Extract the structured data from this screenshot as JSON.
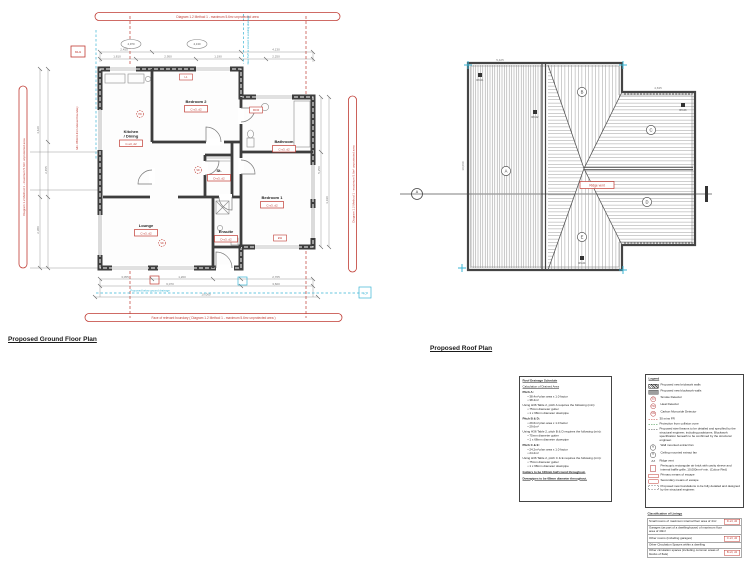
{
  "titles": {
    "ground": "Proposed Ground Floor Plan",
    "roof": "Proposed Roof Plan"
  },
  "colors": {
    "red": "#c03b33",
    "cyan": "#3ab5d5",
    "wall": "#3d3d3d",
    "dim": "#777777"
  },
  "floor_plan": {
    "rooms": [
      {
        "name": "Kitchen / Dining",
        "code": "C-s3, d2",
        "x": 131,
        "y": 133
      },
      {
        "name": "Bedroom 2",
        "code": "C-s3, d2",
        "x": 196,
        "y": 103
      },
      {
        "name": "Bathroom",
        "code": "C-s3, d2",
        "x": 284,
        "y": 143
      },
      {
        "name": "St.",
        "code": "D-s3, d2",
        "x": 219,
        "y": 172
      },
      {
        "name": "Lounge",
        "code": "C-s3, d2",
        "x": 146,
        "y": 227
      },
      {
        "name": "Ensuite",
        "code": "D-s3, d2",
        "x": 226,
        "y": 233
      },
      {
        "name": "Bedroom 1",
        "code": "C-s3, d2",
        "x": 272,
        "y": 199
      }
    ],
    "banners": {
      "top": "Diagram 1.2 Method 1 - maximum 5.6m² unprotected area",
      "bottom": "Face of relevant boundary ( Diagram 1.2 Method 1 - maximum 5.6m² unprotected area )",
      "left": "Diagram 1.2 Method 1 - maximum 5.6m² unprotected area",
      "right": "Diagram 1.2 Method 1 - maximum 5.6m² unprotected area"
    },
    "notes": {
      "boundary": "Min. 850mm from relevant boundary",
      "svp": "New SVP to connect to existing drainage",
      "drain": "Proposed below ground drainage",
      "mh": "MH1",
      "ic": "IC"
    },
    "grid_bubbles": [
      "4,970",
      "4,130"
    ],
    "detectors": [
      {
        "g": "HD",
        "x": 140,
        "y": 114
      },
      {
        "g": "SD",
        "x": 198,
        "y": 170
      },
      {
        "g": "SD",
        "x": 162,
        "y": 243
      }
    ],
    "wall_tags": [
      {
        "t": "L1",
        "x": 186,
        "y": 77
      },
      {
        "t": "FD30",
        "x": 256,
        "y": 110
      },
      {
        "t": "EW",
        "x": 280,
        "y": 238
      }
    ],
    "dims": [
      {
        "t": "2,455",
        "x": 124,
        "y": 50.5
      },
      {
        "t": "4,130",
        "x": 276,
        "y": 50.5
      },
      {
        "t": "1,810",
        "x": 117,
        "y": 57.5
      },
      {
        "t": "2,950",
        "x": 168,
        "y": 57.5
      },
      {
        "t": "1,190",
        "x": 218,
        "y": 57.5
      },
      {
        "t": "2,250",
        "x": 276,
        "y": 57.5
      },
      {
        "t": "3,055",
        "x": 125,
        "y": 277.8
      },
      {
        "t": "1,200",
        "x": 182,
        "y": 277.8
      },
      {
        "t": "2,765",
        "x": 276,
        "y": 277.8
      },
      {
        "t": "6,070",
        "x": 170,
        "y": 284.8
      },
      {
        "t": "3,600",
        "x": 276,
        "y": 284.8
      },
      {
        "t": "10,060",
        "x": 206,
        "y": 295.5
      },
      {
        "t": "4,420",
        "x": 39,
        "y": 130,
        "r": -90
      },
      {
        "t": "2,380",
        "x": 39,
        "y": 230,
        "r": -90
      },
      {
        "t": "2,455",
        "x": 47,
        "y": 170,
        "r": -90
      },
      {
        "t": "5,250",
        "x": 320,
        "y": 170,
        "r": -90
      },
      {
        "t": "3,190",
        "x": 328,
        "y": 200,
        "r": -90
      }
    ]
  },
  "roof_plan": {
    "ridge_label": "Ridge vent",
    "section_letter": "A",
    "letters": [
      {
        "t": "A",
        "x": 106,
        "y": 141
      },
      {
        "t": "B",
        "x": 182,
        "y": 62
      },
      {
        "t": "C",
        "x": 251,
        "y": 100
      },
      {
        "t": "D",
        "x": 247,
        "y": 172
      },
      {
        "t": "E",
        "x": 182,
        "y": 207
      }
    ],
    "vents": [
      {
        "t": "RV-01",
        "x": 80,
        "y": 45
      },
      {
        "t": "RV-02",
        "x": 135,
        "y": 82
      },
      {
        "t": "RV-03",
        "x": 283,
        "y": 75
      },
      {
        "t": "RV-04",
        "x": 182,
        "y": 228
      }
    ],
    "dims": [
      {
        "t": "5,425",
        "x": 100,
        "y": 31
      },
      {
        "t": "4,635",
        "x": 258,
        "y": 59
      },
      {
        "t": "10,060",
        "x": 64,
        "y": 136,
        "r": -90
      }
    ]
  },
  "notes_box": {
    "heading": "Roof Drainage Schedule",
    "subheading": "Calculation of Drained Area",
    "blocks": [
      {
        "title": "Pitch A:",
        "bullets": [
          "38.4m² plan area x 1.0 factor",
          "38.4m²"
        ],
        "using": "Using H36 Table 2, pitch A requires the following (min):",
        "reqs": [
          "75mm diameter gutter",
          "1 x 68mm diameter downpipe"
        ]
      },
      {
        "title": "Pitch B & D:",
        "bullets": [
          "29.6m² plan area x 1.0 factor",
          "29.6m²"
        ],
        "using": "Using H36 Table 2, pitch B & D requires the following (min):",
        "reqs": [
          "75mm diameter gutter",
          "1 x 68mm diameter downpipe"
        ]
      },
      {
        "title": "Pitch C & E:",
        "bullets": [
          "24.2m² plan area x 1.0 factor",
          "24.2m²"
        ],
        "using": "Using H36 Table 2, pitch C & E requires the following (min):",
        "reqs": [
          "75mm diameter gutter",
          "1 x 68mm diameter downpipe"
        ]
      }
    ],
    "footer": [
      "Gutters to be 100mm half round throughout.",
      "Downpipes to be 68mm diameter throughout."
    ]
  },
  "legend": {
    "heading": "Legend",
    "items": [
      {
        "icon": "hatch",
        "label": "Proposed new brickwork walls"
      },
      {
        "icon": "solid",
        "label": "Proposed new blockwork walls"
      },
      {
        "icon": "circle-sd",
        "glyph": "SD",
        "label": "Smoke Detector"
      },
      {
        "icon": "circle-hd",
        "glyph": "HD",
        "label": "Heat Detector"
      },
      {
        "icon": "circle-cm",
        "glyph": "CM",
        "label": "Carbon Monoxide Detector"
      },
      {
        "icon": "dash-red",
        "label": "30 mins FR"
      },
      {
        "icon": "dash-green",
        "label": "Protection from collision zone"
      },
      {
        "icon": "dash-dark",
        "label": "Proposed steel beams to be detailed and specified by the structural engineer, including padstones. Blockwork specification beneath to be confirmed by the structural engineer."
      },
      {
        "icon": "fan-wall",
        "glyph": "≋",
        "label": "Wall mounted extract fan"
      },
      {
        "icon": "fan-ceiling",
        "glyph": "✳",
        "label": "Ceiling mounted extract fan"
      },
      {
        "icon": "ridge",
        "glyph": "∧∧",
        "label": "Ridge vent"
      },
      {
        "icon": "airbrick",
        "label": "Periscopic rectangular air brick with cavity sleeve and internal baffle grille, 10,000mm² min. (Colour Red)"
      },
      {
        "icon": "box-red",
        "label": "Primary means of escape"
      },
      {
        "icon": "box-red",
        "label": "Secondary means of escape"
      },
      {
        "icon": "box-dashed",
        "label": "Proposed new foundations to be fully detailed and designed by the structural engineer."
      }
    ]
  },
  "classification": {
    "heading": "Classification of Linings",
    "rows": [
      {
        "text": "Small rooms of maximum internal floor area of 4m²",
        "code": "D-s3, d2"
      },
      {
        "text": "Garages (as part of a dwellinghouse) of maximum floor area of 40m²",
        "code": ""
      },
      {
        "text": "Other rooms (including garages)",
        "code": "C-s3, d2"
      },
      {
        "text": "Other Circulation Spaces within a dwelling",
        "code": ""
      },
      {
        "text": "Other circulation spaces (including common areas of blocks of flats)",
        "code": "B-s3, d2"
      }
    ]
  }
}
